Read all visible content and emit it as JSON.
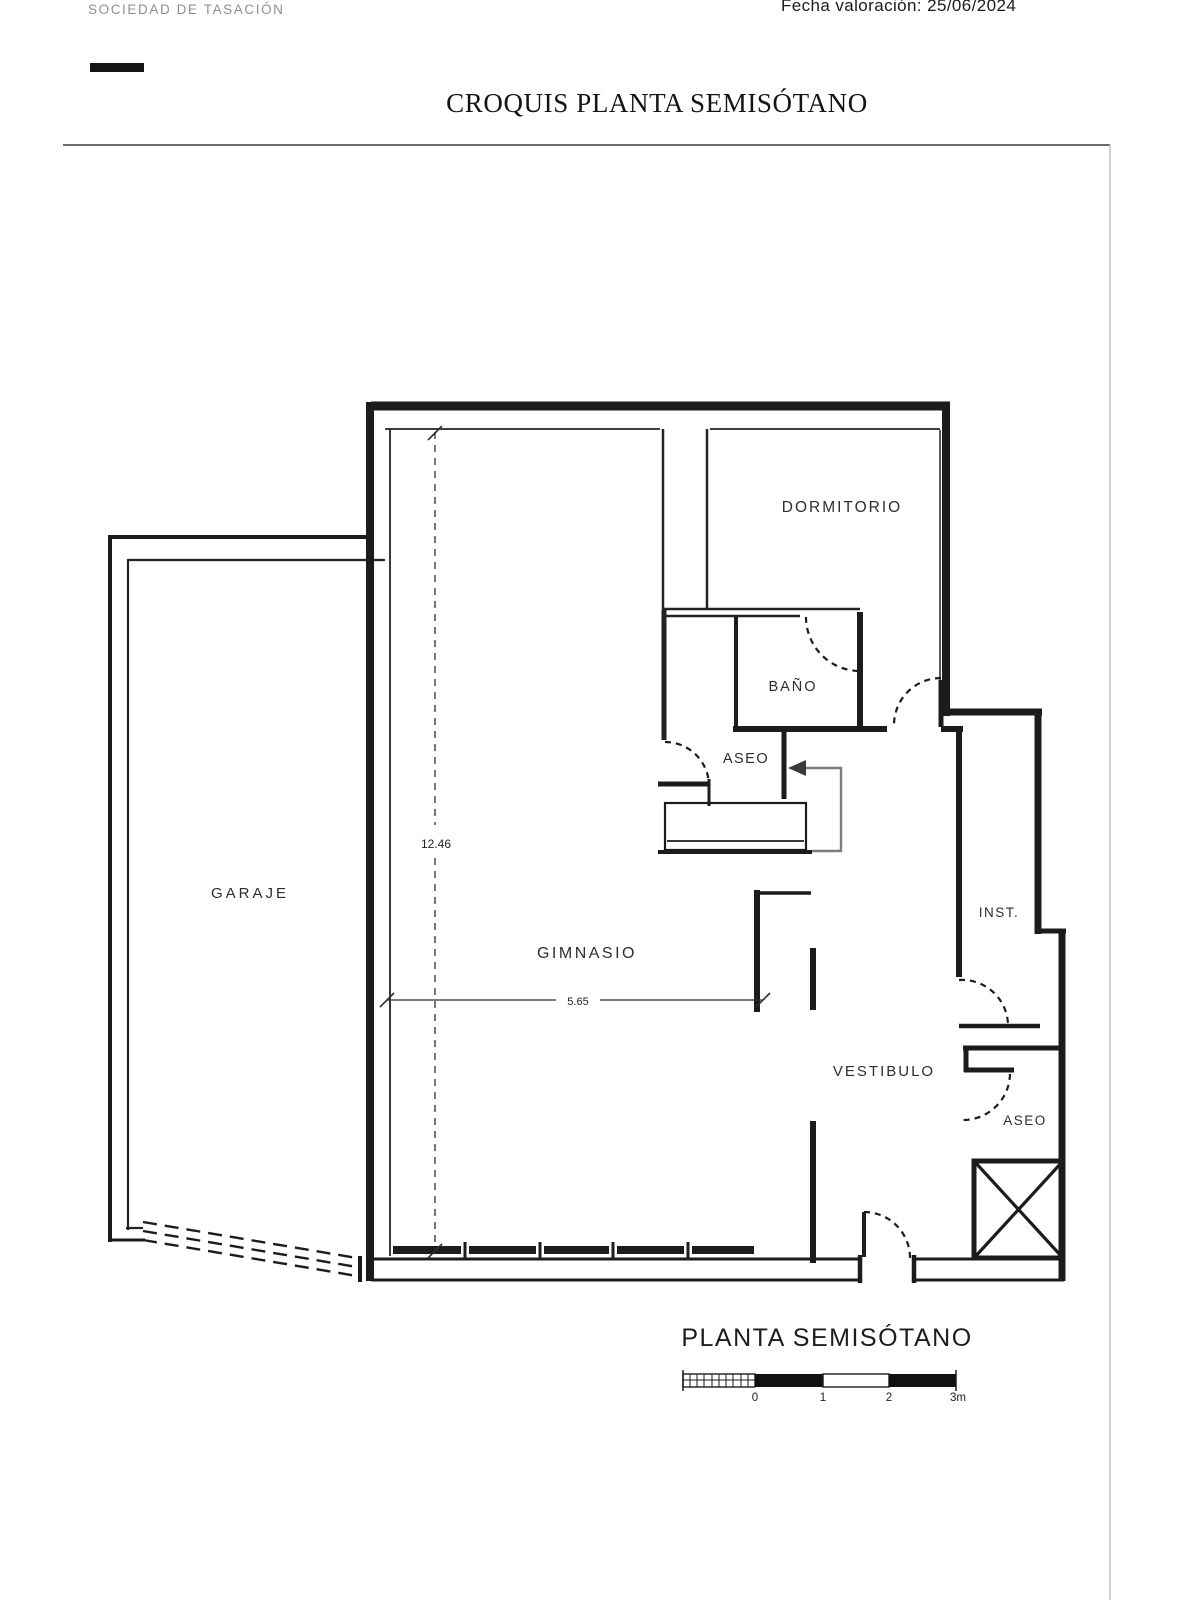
{
  "header": {
    "company": "SOCIEDAD DE TASACIÓN",
    "date_line": "Fecha valoración: 25/06/2024",
    "title": "CROQUIS PLANTA SEMISÓTANO"
  },
  "plan": {
    "labels": {
      "garaje": "GARAJE",
      "gimnasio": "GIMNASIO",
      "dormitorio": "DORMITORIO",
      "bano": "BAÑO",
      "aseo_upper": "ASEO",
      "vestibulo": "VESTIBULO",
      "inst": "INST.",
      "aseo_lower": "ASEO"
    },
    "dimensions": {
      "height_m": "12.46",
      "width_m": "5.65"
    },
    "caption": "PLANTA SEMISÓTANO",
    "scale_bar": {
      "tick0": "0",
      "tick1": "1",
      "tick2": "2",
      "tick3": "3m"
    }
  },
  "colors": {
    "wall": "#1c1c1c",
    "label_text": "#2e2e2e",
    "entry_arrow_gray": "#7d7d7d"
  }
}
